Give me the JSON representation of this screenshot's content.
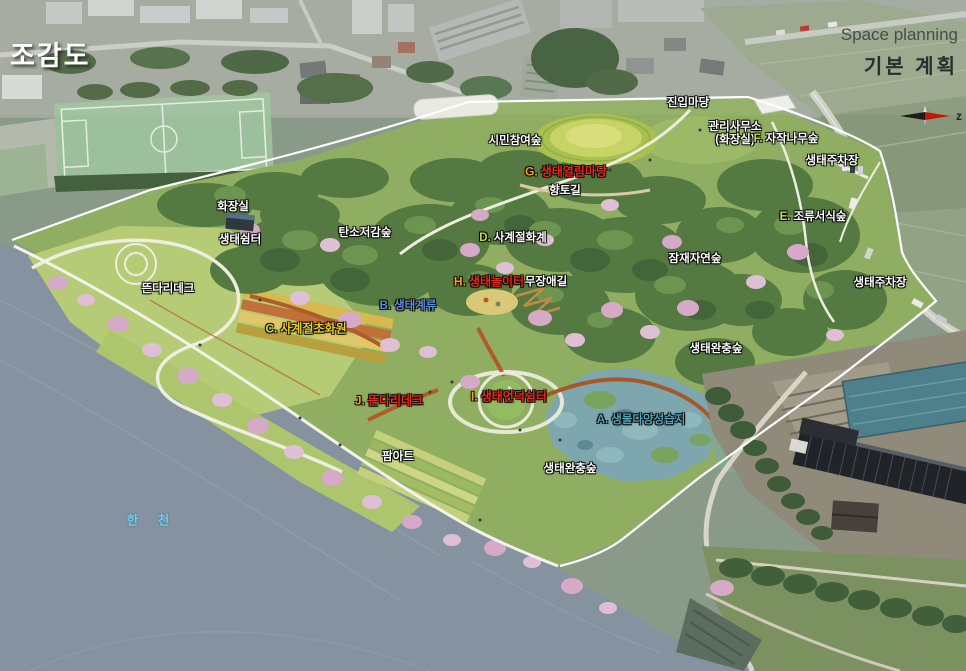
{
  "header": {
    "title": "조감도",
    "space_planning": "Space planning",
    "base_plan": "기본 계획",
    "compass_label": "z"
  },
  "colors": {
    "white": {
      "text": "#ffffff"
    },
    "red": {
      "prefix": "#f6a01e",
      "text": "#e8281e"
    },
    "green-white": {
      "prefix": "#c3da4e",
      "text": "#ffffff"
    },
    "blue": {
      "text": "#5d8ede"
    },
    "teal": {
      "text": "#55a3b8"
    },
    "yellow": {
      "prefix": "#cfd84a",
      "text": "#e9cf2b"
    },
    "water": {
      "text": "#6fc9ea"
    }
  },
  "map_labels": [
    {
      "id": "entry-yard",
      "text": "진입마당",
      "x": 688,
      "y": 102,
      "variant": "white"
    },
    {
      "id": "citizen-forest",
      "text": "시민참여숲",
      "x": 515,
      "y": 140,
      "variant": "white"
    },
    {
      "id": "office-line1",
      "text": "관리사무소",
      "x": 735,
      "y": 126,
      "variant": "white"
    },
    {
      "id": "office-line2",
      "text": "(화장실)",
      "x": 735,
      "y": 139,
      "variant": "white"
    },
    {
      "id": "birch-forest",
      "prefix": "F.",
      "text": "자작나무숲",
      "x": 786,
      "y": 138,
      "variant": "green-white"
    },
    {
      "id": "eco-parking-north",
      "text": "생태주차장",
      "x": 832,
      "y": 160,
      "variant": "white"
    },
    {
      "id": "eco-open-yard",
      "prefix": "G.",
      "text": "생태열림마당",
      "x": 566,
      "y": 171,
      "variant": "red"
    },
    {
      "id": "hyangto-trail",
      "text": "향토길",
      "x": 565,
      "y": 190,
      "variant": "white"
    },
    {
      "id": "bird-habitat-forest",
      "prefix": "E.",
      "text": "조류서식숲",
      "x": 813,
      "y": 216,
      "variant": "green-white"
    },
    {
      "id": "restroom",
      "text": "화장실",
      "x": 233,
      "y": 206,
      "variant": "white"
    },
    {
      "id": "eco-shelter",
      "text": "생태쉼터",
      "x": 240,
      "y": 239,
      "variant": "white"
    },
    {
      "id": "carbon-reduction-forest",
      "text": "탄소저감숲",
      "x": 365,
      "y": 232,
      "variant": "white"
    },
    {
      "id": "four-season-flower-steps",
      "prefix": "D.",
      "text": "사계절화계",
      "x": 513,
      "y": 237,
      "variant": "green-white"
    },
    {
      "id": "potential-natural-forest",
      "text": "잠재자연숲",
      "x": 695,
      "y": 258,
      "variant": "white"
    },
    {
      "id": "eco-playground",
      "prefix": "H.",
      "text": "생태놀이터",
      "x": 489,
      "y": 281,
      "variant": "red"
    },
    {
      "id": "barrier-free-trail",
      "text": "무장애길",
      "x": 546,
      "y": 281,
      "variant": "white"
    },
    {
      "id": "eco-parking-east",
      "text": "생태주차장",
      "x": 880,
      "y": 282,
      "variant": "white"
    },
    {
      "id": "floating-deck-west",
      "text": "뜬다리데크",
      "x": 168,
      "y": 288,
      "variant": "white"
    },
    {
      "id": "eco-stream",
      "prefix": "B.",
      "text": "생태계류",
      "x": 408,
      "y": 305,
      "variant": "blue"
    },
    {
      "id": "four-season-garden",
      "prefix": "C.",
      "text": "사계절초화원",
      "x": 306,
      "y": 328,
      "variant": "yellow"
    },
    {
      "id": "eco-buffer-forest-east",
      "text": "생태완충숲",
      "x": 716,
      "y": 348,
      "variant": "white"
    },
    {
      "id": "floating-deck-south",
      "prefix": "J.",
      "text": "뜬다리데크",
      "x": 389,
      "y": 400,
      "variant": "red"
    },
    {
      "id": "eco-hill-shelter",
      "prefix": "I.",
      "text": "생태언덕쉼터",
      "x": 509,
      "y": 396,
      "variant": "red"
    },
    {
      "id": "biodiversity-wetland",
      "prefix": "A.",
      "text": "생물다양성습지",
      "x": 641,
      "y": 419,
      "variant": "teal"
    },
    {
      "id": "farm-art",
      "text": "팜아트",
      "x": 398,
      "y": 456,
      "variant": "white"
    },
    {
      "id": "eco-buffer-forest-south",
      "text": "생태완충숲",
      "x": 570,
      "y": 468,
      "variant": "white"
    },
    {
      "id": "river-name",
      "text": "한 천",
      "x": 152,
      "y": 519,
      "variant": "water"
    }
  ]
}
